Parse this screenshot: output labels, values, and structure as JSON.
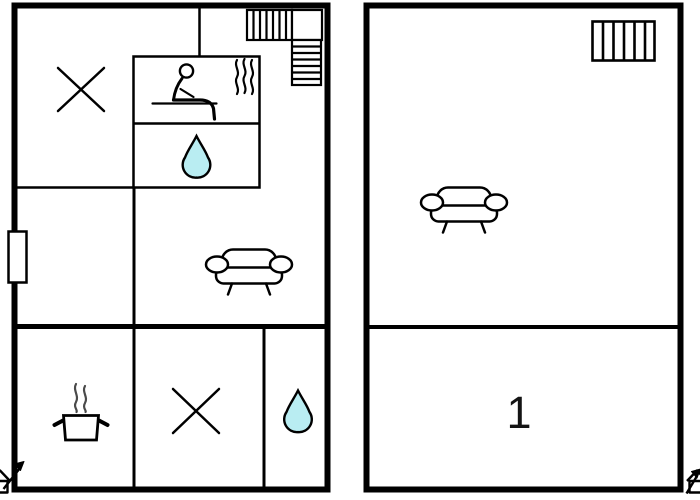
{
  "colors": {
    "wall": "#000000",
    "background": "#ffffff",
    "water_drop": "#b9edf2",
    "steam": "#4a4a4a"
  },
  "left_plan": {
    "rooms": {
      "top_left": {
        "icon": "x-mark"
      },
      "sauna": {
        "icon": "sauna-person-with-steam"
      },
      "shower": {
        "icon": "water-drop"
      },
      "hall": {
        "icon": "door-opening"
      },
      "living": {
        "icon": "sofa"
      },
      "kitchen": {
        "icon": "cooking-pot-with-steam"
      },
      "bottom_middle": {
        "icon": "x-mark"
      },
      "bathroom": {
        "icon": "water-drop"
      }
    },
    "stairs": {
      "icon": "staircase-l-shaped"
    },
    "entrance": {
      "icon": "entrance-arrow-house"
    }
  },
  "right_plan": {
    "room_label": "1",
    "living": {
      "icon": "sofa"
    },
    "stairs": {
      "icon": "staircase-straight"
    },
    "entrance": {
      "icon": "entrance-arrow-house"
    }
  }
}
